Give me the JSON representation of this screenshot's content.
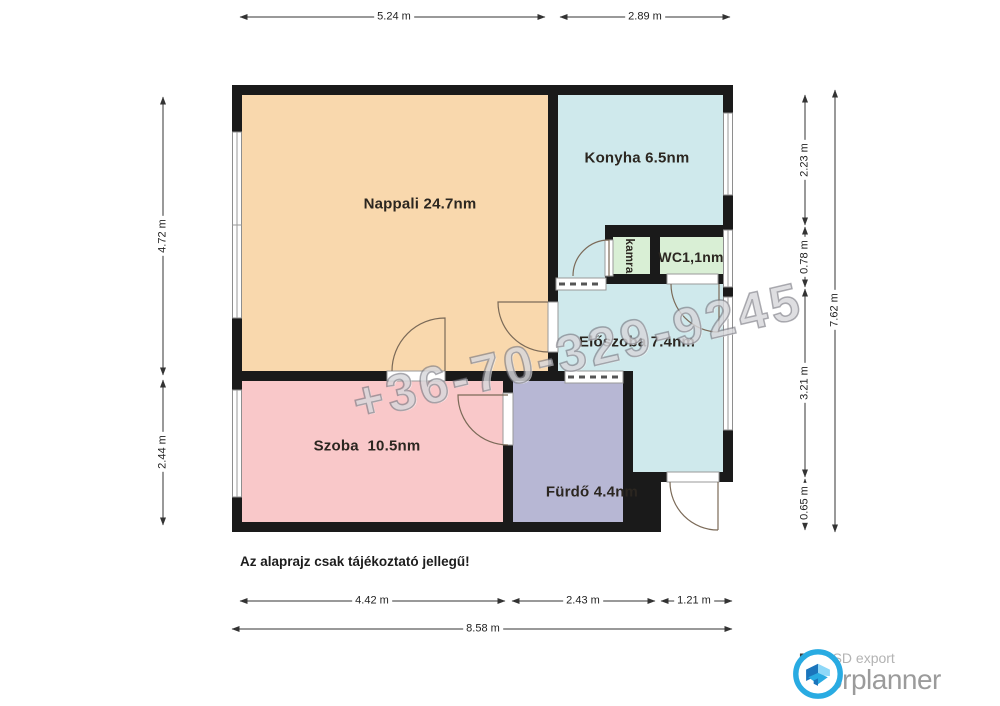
{
  "floorplan": {
    "watermark": "+36-70-329-9245",
    "disclaimer": "Az alaprajz csak tájékoztató jellegű!",
    "rooms": [
      {
        "id": "nappali",
        "label": "Nappali 24.7nm",
        "color": "#f9d8ad"
      },
      {
        "id": "konyha",
        "label": "Konyha 6.5nm",
        "color": "#cfe9ec"
      },
      {
        "id": "kamra",
        "label": "kamra",
        "color": "#d9efd5"
      },
      {
        "id": "wc",
        "label": "WC1,1nm",
        "color": "#d9efd5"
      },
      {
        "id": "eloszoba",
        "label": "Előszoba 7.4nm",
        "color": "#cfe9ec"
      },
      {
        "id": "szoba",
        "label": "Szoba  10.5nm",
        "color": "#f9c8c9"
      },
      {
        "id": "furdo",
        "label": "Fürdő 4.4nm",
        "color": "#b7b7d4"
      }
    ],
    "wall_color": "#1a1a1a",
    "dimensions": {
      "top": [
        "5.24 m",
        "2.89 m"
      ],
      "left": [
        "4.72 m",
        "2.44 m"
      ],
      "right": [
        "2.23 m",
        "0.78 m",
        "3.21 m",
        "0.65 m"
      ],
      "right_total": "7.62 m",
      "bottom": [
        "4.42 m",
        "2.43 m",
        "1.21 m"
      ],
      "bottom_total": "8.58 m"
    }
  },
  "branding": {
    "free_label": "Free",
    "export_label": "SD export",
    "brand_name": "floorplanner",
    "logo_blue": "#29abe2",
    "logo_dark_blue": "#1b75bc"
  }
}
